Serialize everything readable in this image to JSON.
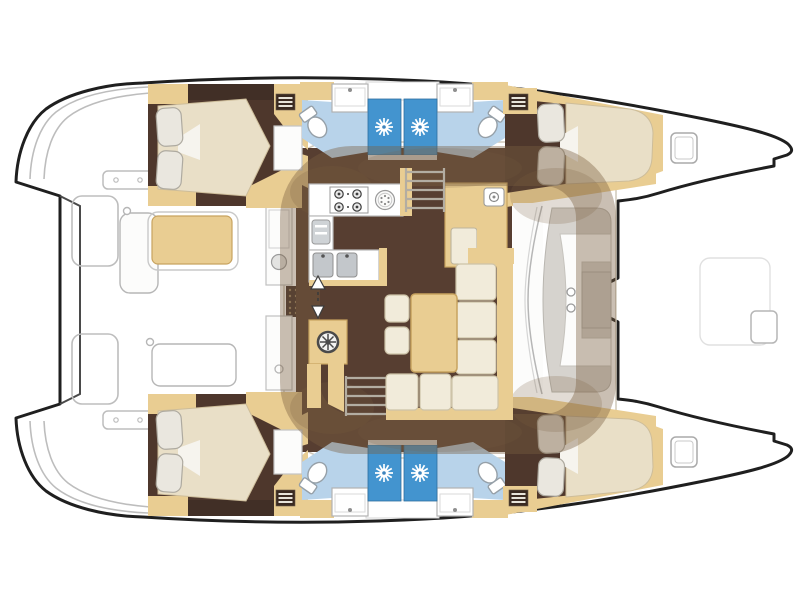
{
  "diagram": {
    "type": "floor-plan",
    "subject": "Catamaran sailing yacht interior layout, top-down view, bows to the right, sterns to the left",
    "symmetry": "port and starboard hulls mirrored",
    "counts": {
      "double_cabins": 4,
      "heads": 4,
      "shower_stalls": 4,
      "toilets": 4,
      "wash_basins": 4,
      "companionway_ladders": 4,
      "foredeck_hatches": 2,
      "pillows_per_bed": 2
    },
    "hull_features": [
      "transom swim steps",
      "aft double cabin",
      "aft head with toilet and basin",
      "two adjoining shower stalls",
      "forward head with toilet and basin",
      "forward double cabin",
      "foredeck hatch"
    ],
    "bridgedeck_features": [
      "aft platform",
      "cockpit bench with cushion",
      "cockpit table",
      "helm seat back",
      "galley with 4-burner stove",
      "round sink",
      "refrigerator",
      "double sink",
      "companionway direction arrow",
      "wheel locker",
      "starboard hull steps",
      "port hull steps",
      "nav locker with instrument",
      "nav seat",
      "L-shaped sofa",
      "saloon table",
      "two stools",
      "forward lounge seat with cup holders",
      "anchor locker hatch"
    ]
  },
  "colors": {
    "outline": "#1f1f1f",
    "deck_line": "#b6b6b6",
    "white": "#ffffff",
    "panel_white": "#fcfcfb",
    "hull_floor": "#4e372c",
    "saloon_floor": "#573e31",
    "headboard": "#412f26",
    "wood": "#e9cd92",
    "wood_edge": "#c8a35f",
    "mattress": "#e9dfc7",
    "cushion": "#f1ebda",
    "cushion_edge": "#cdc3a8",
    "pillow": "#eae7df",
    "pillow_edge": "#aeaaa0",
    "bath_floor": "#b8d3ea",
    "shower": "#4394cf",
    "seat_gray": "#d6d3ce",
    "seat_gray_dark": "#cfccc6",
    "steel": "#c3c7cb",
    "fixture_gray": "#e3e3e1",
    "mat_brown": "#42302a",
    "shadow": "rgba(122,95,66,0.40)"
  }
}
